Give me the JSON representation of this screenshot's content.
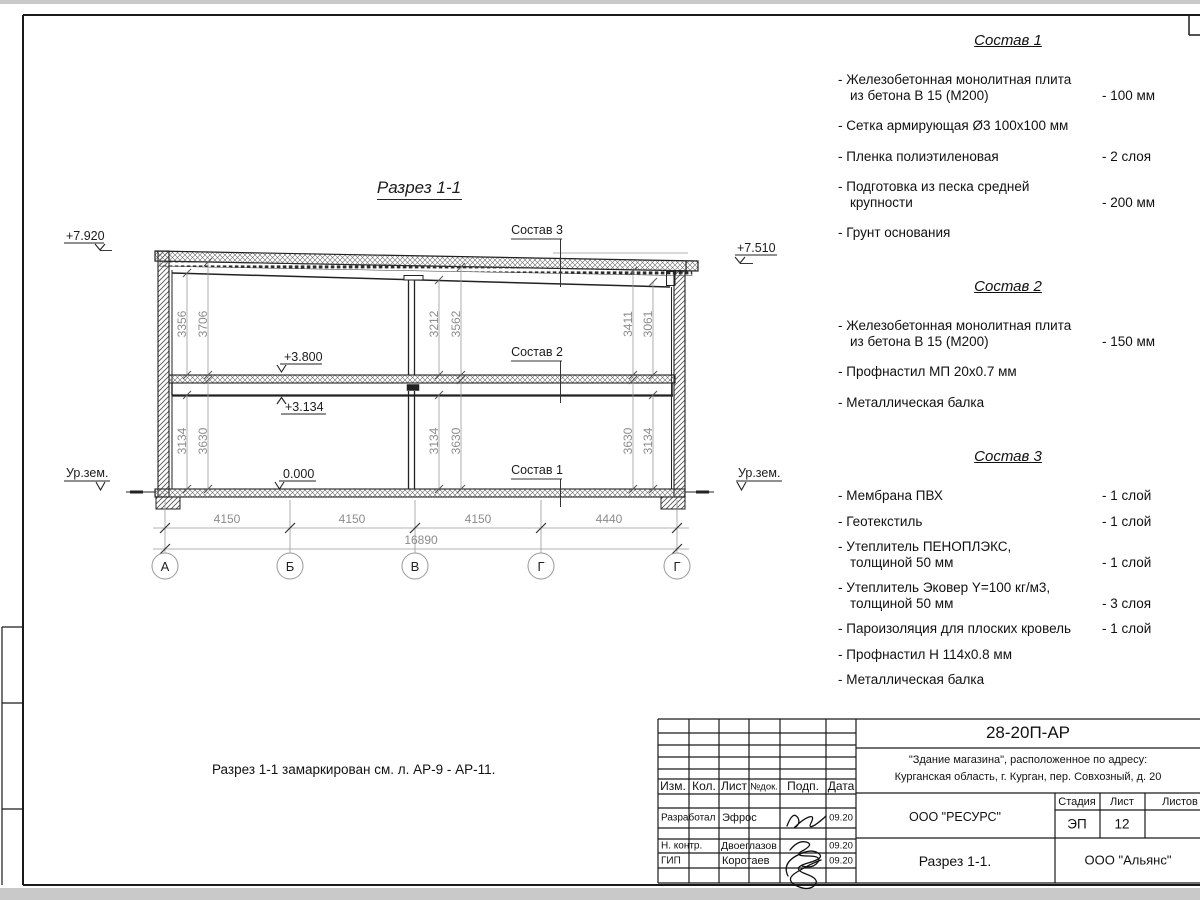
{
  "drawing": {
    "title": "Разрез 1-1",
    "note": "Разрез 1-1 замаркирован см. л. АР-9 - АР-11.",
    "elev_roof_left": "+7.920",
    "elev_roof_right": "+7.510",
    "elev_floor2": "+3.800",
    "elev_beam": "+3.134",
    "elev_zero": "0.000",
    "ground_left": "Ур.зем.",
    "ground_right": "Ур.зем.",
    "label_c3": "Состав 3",
    "label_c2": "Состав 2",
    "label_c1": "Состав 1",
    "dims_upper": [
      "3356",
      "3706",
      "3212",
      "3562",
      "3411",
      "3061"
    ],
    "dims_lower": [
      "3134",
      "3630",
      "3134",
      "3630",
      "3630",
      "3134"
    ],
    "dims_bottom": [
      "4150",
      "4150",
      "4150",
      "4440"
    ],
    "dim_total": "16890",
    "axes": [
      "А",
      "Б",
      "В",
      "Г",
      "Г"
    ]
  },
  "compositions": [
    {
      "title": "Состав 1",
      "items": [
        {
          "name": "- Железобетонная  монолитная плита\nиз бетона В 15 (М200)",
          "value": "- 100 мм"
        },
        {
          "name": "- Сетка армирующая Ø3 100х100 мм",
          "value": ""
        },
        {
          "name": "- Пленка полиэтиленовая",
          "value": "-  2 слоя"
        },
        {
          "name": "- Подготовка из песка средней\nкрупности",
          "value": "- 200 мм"
        },
        {
          "name": "- Грунт основания",
          "value": ""
        }
      ]
    },
    {
      "title": "Состав 2",
      "items": [
        {
          "name": "- Железобетонная  монолитная плита\nиз бетона В 15 (М200)",
          "value": "- 150 мм"
        },
        {
          "name": "- Профнастил МП 20х0.7 мм",
          "value": ""
        },
        {
          "name": "- Металлическая балка",
          "value": ""
        }
      ]
    },
    {
      "title": "Состав 3",
      "items": [
        {
          "name": "- Мембрана ПВХ",
          "value": "- 1 слой"
        },
        {
          "name": "- Геотекстиль",
          "value": "- 1 слой"
        },
        {
          "name": "- Утеплитель ПЕНОПЛЭКС,\nтолщиной 50 мм",
          "value": "- 1 слой"
        },
        {
          "name": "- Утеплитель Эковер Y=100 кг/м3,\nтолщиной 50 мм",
          "value": "- 3 слоя"
        },
        {
          "name": "- Пароизоляция для плоских кровель",
          "value": "- 1 слой"
        },
        {
          "name": "- Профнастил Н 114х0.8 мм",
          "value": ""
        },
        {
          "name": "- Металлическая балка",
          "value": ""
        }
      ]
    }
  ],
  "titleblock": {
    "doc_code": "28-20П-АР",
    "object_line1": "\"Здание магазина\", расположенное по адресу:",
    "object_line2": "Курганская область, г. Курган, пер. Совхозный, д. 20",
    "org": "ООО \"РЕСУРС\"",
    "sheet_name": "Разрез 1-1.",
    "company": "ООО \"Альянс\"",
    "stage_label": "Стадия",
    "sheet_label": "Лист",
    "sheets_label": "Листов",
    "stage": "ЭП",
    "sheet_no": "12",
    "cols": {
      "izm": "Изм.",
      "kol": "Кол.",
      "list": "Лист",
      "ndoc": "№док.",
      "podp": "Подп.",
      "data": "Дата"
    },
    "rows": [
      {
        "role": "Разработал",
        "name": "Эфрос",
        "date": "09.20"
      },
      {
        "role": "Н. контр.",
        "name": "Двоеглазов",
        "date": "09.20"
      },
      {
        "role": "ГИП",
        "name": "Коротаев",
        "date": "09.20"
      }
    ]
  }
}
